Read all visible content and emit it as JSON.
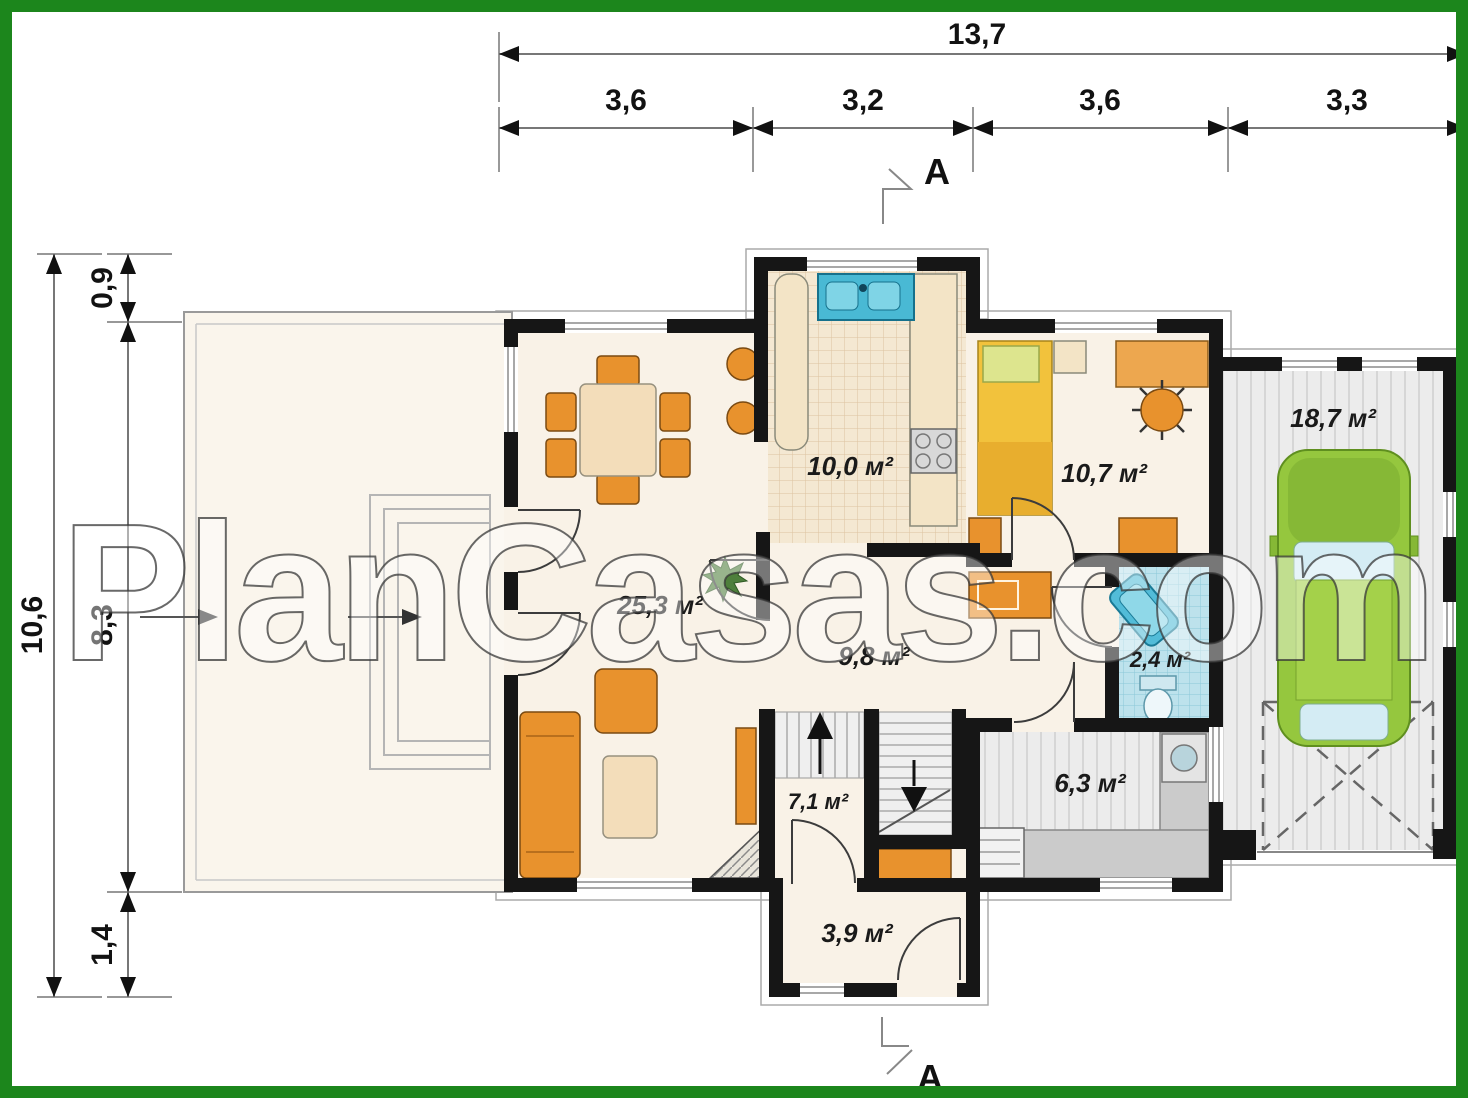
{
  "watermark": {
    "text": "PlanCasas.com"
  },
  "dimensions": {
    "top": {
      "total": "13,7",
      "segments": [
        "3,6",
        "3,2",
        "3,6",
        "3,3"
      ]
    },
    "left": {
      "total": "10,6",
      "segments": [
        "0,9",
        "8,3",
        "1,4"
      ]
    },
    "section_label": "A"
  },
  "rooms": {
    "kitchen": {
      "area": "10,0 м²"
    },
    "bedroom": {
      "area": "10,7 м²"
    },
    "garage": {
      "area": "18,7 м²"
    },
    "living_room": {
      "area": "25,3 м²"
    },
    "hall": {
      "area": "9,8 м²"
    },
    "bathroom": {
      "area": "2,4 м²"
    },
    "utility": {
      "area": "6,3 м²"
    },
    "stair_hall": {
      "area": "7,1 м²"
    },
    "vestibule": {
      "area": "3,9 м²"
    }
  },
  "colors": {
    "frame_green": "#1c861c",
    "wall_black": "#161616",
    "furniture_orange": "#e8922d",
    "bed_yellow": "#f2c23c",
    "water_blue": "#49b9d4",
    "car_green": "#95c73e",
    "floor_cream": "#f9f2e7"
  }
}
